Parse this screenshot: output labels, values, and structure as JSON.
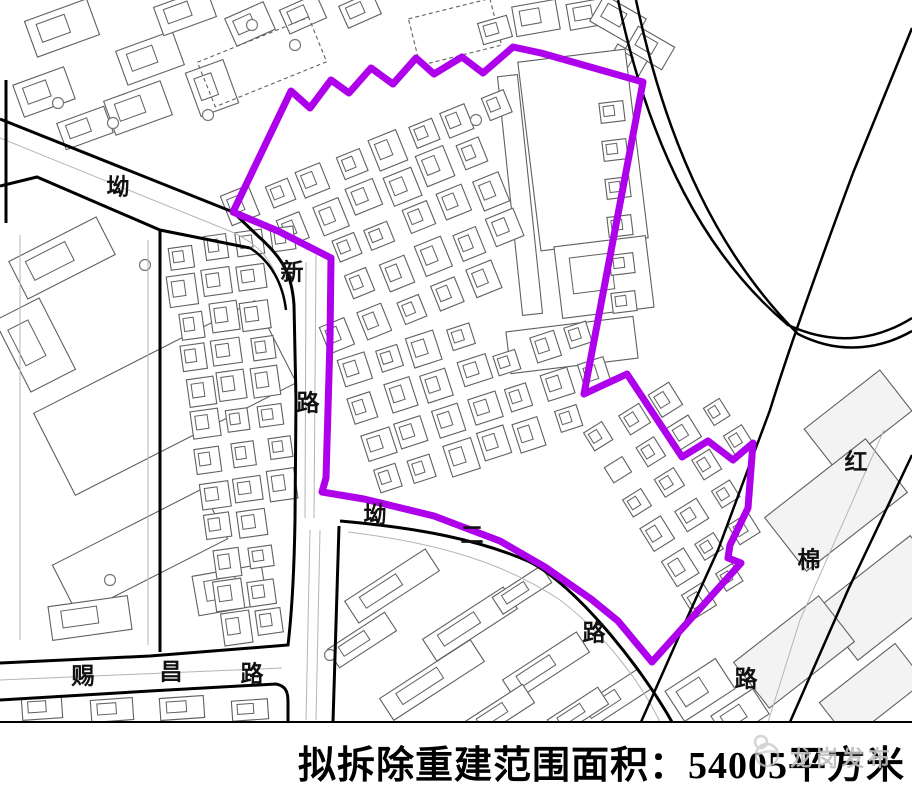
{
  "caption": {
    "text": "拟拆除重建范围面积：54005平方米"
  },
  "watermark": {
    "text": "龙岗发布",
    "color": "#bdbdbd"
  },
  "map": {
    "width": 912,
    "height": 723,
    "colors": {
      "boundary": "#AE00EB",
      "road": "#000000",
      "building_stroke": "#606060",
      "building_fill": "#ffffff",
      "building_light_fill": "#f3f3f3",
      "thin_line": "#b5b5b5"
    },
    "boundary_points": "233,212 291,91 310,108 331,80 349,93 371,68 393,84 416,58 434,74 462,57 483,73 513,47 541,53 643,82 584,394 627,374 682,457 708,441 733,460 753,443 748,508 730,545 728,558 741,563 652,662 618,621 591,599 545,567 500,541 434,516 364,499 322,492 326,478 330,340 331,258 278,231",
    "roads": [
      {
        "d": "M0,119 L233,212 L258,236 C283,258 292,275 294,305 L296,400 L295,520 C294,580 291,620 288,645 L150,656 L0,663",
        "w": 3
      },
      {
        "d": "M0,186 L37,177 L160,230 L250,248",
        "w": 3
      },
      {
        "d": "M250,248 C272,262 283,285 286,310",
        "w": 2.5
      },
      {
        "d": "M160,230 L160,652",
        "w": 3
      },
      {
        "d": "M6,80 L6,223",
        "w": 3
      },
      {
        "d": "M0,700 L150,691 L276,684 C286,686 288,692 288,702 L288,722",
        "w": 3
      },
      {
        "d": "M339,526 L333,722",
        "w": 3
      },
      {
        "d": "M340,521 C420,528 480,540 530,562 C575,585 640,665 672,722",
        "w": 3
      },
      {
        "d": "M912,28 L853,173 C830,235 790,345 770,410 L718,550 L688,616 L641,722",
        "w": 2.5
      },
      {
        "d": "M912,455 L848,590 L790,722",
        "w": 2.5
      },
      {
        "d": "M618,0 C650,150 705,255 788,325 C838,348 880,338 912,318",
        "w": 2.5
      },
      {
        "d": "M636,0 C668,152 722,258 798,334 C843,357 884,347 912,331",
        "w": 2.5
      },
      {
        "d": "M0,722 L912,722",
        "w": 2
      }
    ],
    "thin_lines": [
      {
        "d": "M0,138 L232,232 C258,244 270,258 278,280"
      },
      {
        "d": "M306,262 L305,518"
      },
      {
        "d": "M316,255 L314,518"
      },
      {
        "d": "M0,680 L282,668"
      },
      {
        "d": "M348,532 C430,542 500,560 560,600 C600,630 640,680 660,722"
      },
      {
        "d": "M310,530 L306,720"
      },
      {
        "d": "M320,530 L316,720"
      },
      {
        "d": "M884,430 L800,620 L768,722"
      },
      {
        "d": "M20,235 L20,640"
      },
      {
        "d": "M148,240 L148,645"
      }
    ],
    "labels": [
      {
        "t": "坳",
        "x": 118,
        "y": 187
      },
      {
        "t": "新",
        "x": 292,
        "y": 272
      },
      {
        "t": "路",
        "x": 308,
        "y": 403
      },
      {
        "t": "坳",
        "x": 375,
        "y": 515
      },
      {
        "t": "二",
        "x": 472,
        "y": 535
      },
      {
        "t": "路",
        "x": 594,
        "y": 633
      },
      {
        "t": "路",
        "x": 746,
        "y": 679
      },
      {
        "t": "红",
        "x": 856,
        "y": 462
      },
      {
        "t": "棉",
        "x": 809,
        "y": 560
      },
      {
        "t": "赐",
        "x": 83,
        "y": 676
      },
      {
        "t": "昌",
        "x": 171,
        "y": 672
      },
      {
        "t": "路",
        "x": 252,
        "y": 674
      }
    ],
    "label_font_px": 23,
    "grids": [
      {
        "ox": 243,
        "oy": 208,
        "ax": 36,
        "ay": -15,
        "bx": 15,
        "by": 36,
        "ni": 14,
        "nj": 5,
        "s": 26,
        "rot": -22,
        "clip": [
          236,
          6,
          648,
          338
        ],
        "ex": [
          [
            505,
            40,
            655,
            360
          ],
          [
            236,
            242,
            334,
            340
          ]
        ]
      },
      {
        "ox": 180,
        "oy": 255,
        "ax": 34,
        "ay": -5,
        "bx": 5,
        "by": 34,
        "ni": 4,
        "nj": 12,
        "s": 25,
        "rot": -8,
        "clip": [
          160,
          236,
          284,
          652
        ],
        "ex": []
      },
      {
        "ox": 352,
        "oy": 372,
        "ax": 36,
        "ay": -12,
        "bx": 12,
        "by": 36,
        "ni": 7,
        "nj": 4,
        "s": 26,
        "rot": -18,
        "clip": [
          336,
          322,
          600,
          510
        ],
        "ex": []
      },
      {
        "ox": 600,
        "oy": 438,
        "ax": 32,
        "ay": -20,
        "bx": 20,
        "by": 32,
        "ni": 5,
        "nj": 6,
        "s": 22,
        "rot": -32,
        "clip": [
          586,
          392,
          752,
          652
        ],
        "ex": [
          [
            586,
            560,
            636,
            660
          ]
        ]
      }
    ],
    "rects": [
      [
        62,
        28,
        66,
        38,
        -20
      ],
      [
        150,
        58,
        60,
        36,
        -20
      ],
      [
        44,
        92,
        54,
        34,
        -20
      ],
      [
        138,
        108,
        60,
        36,
        -20
      ],
      [
        212,
        88,
        40,
        46,
        -20
      ],
      [
        85,
        128,
        50,
        28,
        -20
      ],
      [
        185,
        12,
        56,
        30,
        -20
      ],
      [
        250,
        24,
        42,
        30,
        -24
      ],
      [
        303,
        14,
        40,
        26,
        -24
      ],
      [
        360,
        10,
        36,
        24,
        -24
      ],
      [
        262,
        62,
        120,
        48,
        -22,
        0,
        1
      ],
      [
        455,
        32,
        84,
        48,
        -14,
        0,
        1
      ],
      [
        536,
        18,
        44,
        30,
        -10
      ],
      [
        588,
        14,
        40,
        26,
        -10
      ],
      [
        495,
        30,
        30,
        22,
        -16
      ],
      [
        618,
        20,
        48,
        30,
        30
      ],
      [
        650,
        48,
        42,
        26,
        30
      ],
      [
        627,
        62,
        34,
        22,
        30
      ],
      [
        520,
        195,
        20,
        240,
        -6
      ],
      [
        583,
        150,
        108,
        190,
        -7
      ],
      [
        604,
        277,
        92,
        72,
        -7
      ],
      [
        572,
        345,
        128,
        42,
        -7
      ],
      [
        612,
        112,
        24,
        20,
        -7
      ],
      [
        615,
        150,
        24,
        20,
        -7
      ],
      [
        618,
        188,
        24,
        20,
        -7
      ],
      [
        620,
        226,
        24,
        20,
        -7
      ],
      [
        622,
        264,
        24,
        20,
        -7
      ],
      [
        624,
        302,
        24,
        20,
        -7
      ],
      [
        165,
        398,
        248,
        92,
        -27
      ],
      [
        140,
        552,
        168,
        56,
        -27
      ],
      [
        62,
        258,
        98,
        42,
        -27
      ],
      [
        35,
        345,
        50,
        80,
        -27
      ],
      [
        230,
        590,
        70,
        40,
        -10
      ],
      [
        90,
        618,
        80,
        34,
        -8
      ],
      [
        392,
        586,
        96,
        26,
        -33
      ],
      [
        470,
        624,
        96,
        26,
        -33
      ],
      [
        546,
        666,
        88,
        24,
        -33
      ],
      [
        432,
        680,
        108,
        26,
        -33
      ],
      [
        362,
        640,
        68,
        22,
        -33
      ],
      [
        522,
        590,
        58,
        20,
        -33
      ],
      [
        612,
        700,
        78,
        24,
        -33
      ],
      [
        500,
        712,
        68,
        22,
        -33
      ],
      [
        578,
        712,
        60,
        20,
        -33
      ],
      [
        700,
        690,
        60,
        36,
        -33
      ],
      [
        740,
        715,
        50,
        30,
        -33
      ],
      [
        858,
        420,
        96,
        52,
        -38,
        1
      ],
      [
        836,
        505,
        128,
        68,
        -38,
        1
      ],
      [
        884,
        598,
        118,
        66,
        -38,
        1
      ],
      [
        794,
        652,
        108,
        58,
        -38,
        1
      ],
      [
        872,
        692,
        96,
        48,
        -38,
        1
      ],
      [
        42,
        708,
        40,
        22,
        -4
      ],
      [
        112,
        710,
        42,
        22,
        -4
      ],
      [
        182,
        708,
        44,
        22,
        -4
      ],
      [
        250,
        710,
        36,
        20,
        -4
      ]
    ],
    "circles": [
      [
        252,
        25
      ],
      [
        295,
        45
      ],
      [
        58,
        103
      ],
      [
        113,
        123
      ],
      [
        208,
        115
      ],
      [
        145,
        265
      ],
      [
        110,
        580
      ],
      [
        330,
        655
      ],
      [
        476,
        120
      ]
    ]
  }
}
